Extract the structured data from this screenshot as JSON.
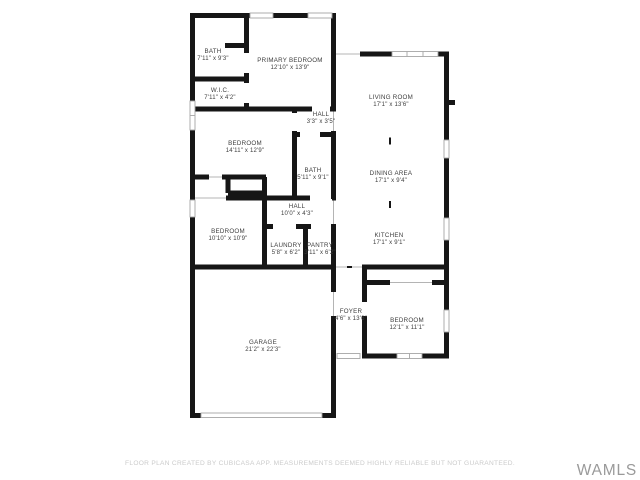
{
  "floor_plan": {
    "rooms": [
      {
        "id": "bath-primary",
        "name": "BATH",
        "dims": "7'11\" x 9'3\"",
        "x": 213,
        "y": 53
      },
      {
        "id": "primary-bedroom",
        "name": "PRIMARY BEDROOM",
        "dims": "12'10\" x 13'9\"",
        "x": 290,
        "y": 62
      },
      {
        "id": "wic",
        "name": "W.I.C.",
        "dims": "7'11\" x 4'2\"",
        "x": 220,
        "y": 92
      },
      {
        "id": "hall-small",
        "name": "HALL",
        "dims": "3'3\" x 3'5\"",
        "x": 321,
        "y": 116
      },
      {
        "id": "bedroom-middle",
        "name": "BEDROOM",
        "dims": "14'11\" x 12'9\"",
        "x": 245,
        "y": 145
      },
      {
        "id": "bath-hall",
        "name": "BATH",
        "dims": "5'11\" x 9'1\"",
        "x": 313,
        "y": 172
      },
      {
        "id": "living-room",
        "name": "LIVING ROOM",
        "dims": "17'1\" x 13'6\"",
        "x": 391,
        "y": 99
      },
      {
        "id": "dining-area",
        "name": "DINING AREA",
        "dims": "17'1\" x 9'4\"",
        "x": 391,
        "y": 175
      },
      {
        "id": "kitchen",
        "name": "KITCHEN",
        "dims": "17'1\" x 9'1\"",
        "x": 389,
        "y": 237
      },
      {
        "id": "hall-long",
        "name": "HALL",
        "dims": "10'0\" x 4'3\"",
        "x": 297,
        "y": 208
      },
      {
        "id": "bedroom-lower",
        "name": "BEDROOM",
        "dims": "10'10\" x 10'9\"",
        "x": 228,
        "y": 233
      },
      {
        "id": "laundry",
        "name": "LAUNDRY",
        "dims": "5'8\" x 6'2\"",
        "x": 286,
        "y": 247
      },
      {
        "id": "pantry",
        "name": "PANTRY",
        "dims": "3'11\" x 6'2\"",
        "x": 320,
        "y": 247
      },
      {
        "id": "garage",
        "name": "GARAGE",
        "dims": "21'2\" x 22'3\"",
        "x": 263,
        "y": 344
      },
      {
        "id": "foyer",
        "name": "FOYER",
        "dims": "4'6\" x 13'6\"",
        "x": 351,
        "y": 313
      },
      {
        "id": "bedroom-rear",
        "name": "BEDROOM",
        "dims": "12'1\" x 11'1\"",
        "x": 407,
        "y": 322
      }
    ]
  },
  "footer": {
    "disclaimer": "FLOOR PLAN CREATED BY CUBICASA APP. MEASUREMENTS DEEMED HIGHLY RELIABLE BUT NOT GUARANTEED."
  },
  "watermark": {
    "text": "WAMLS"
  },
  "colors": {
    "wall": "#161616",
    "window": "#a6a6a6",
    "opening": "#b4b4b4",
    "label": "#3d3d3d",
    "disclaimer": "#cbcbcb",
    "watermark": "#9a9a9a"
  }
}
